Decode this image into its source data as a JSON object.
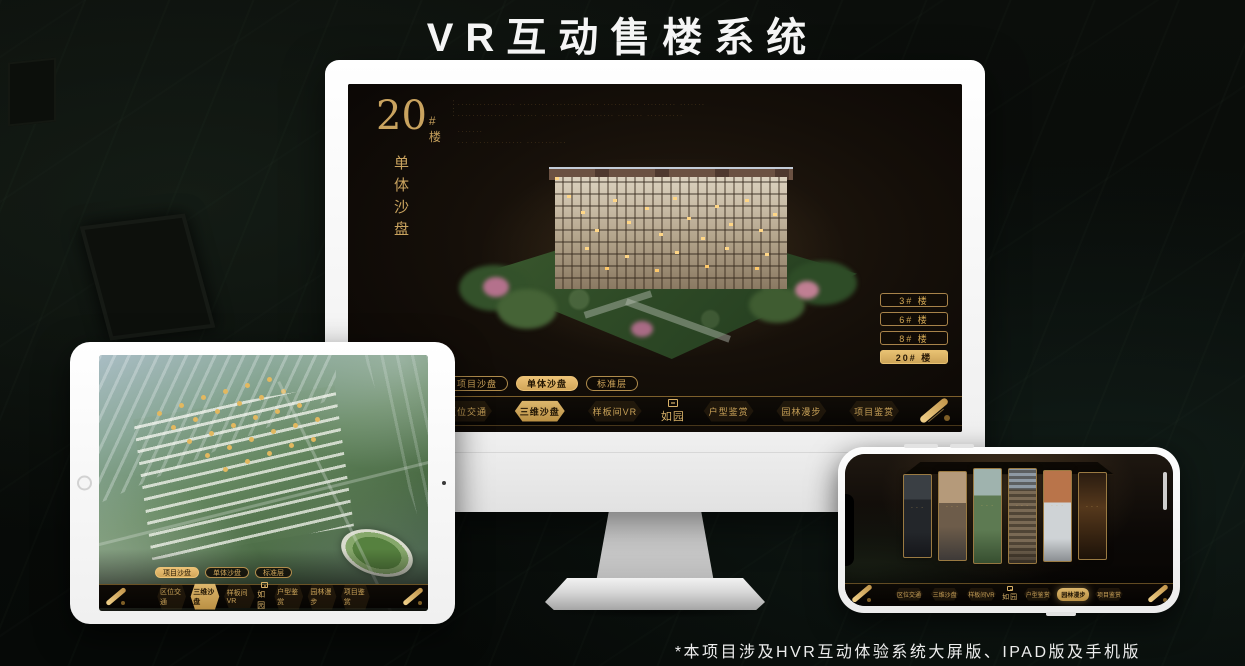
{
  "page": {
    "title": "VR互动售楼系统",
    "footnote": "*本项目涉及HVR互动体验系统大屏版、IPAD版及手机版"
  },
  "colors": {
    "gold": "#d2a85c",
    "gold_active": "#e8c172",
    "screen_background": "#120d08",
    "nav_background": "#0b0805",
    "title_white": "#f5f5f5"
  },
  "monitor": {
    "badge": {
      "number": "20",
      "suffix": "#楼",
      "title": "单体沙盘",
      "side_marks": "·····"
    },
    "description_lines": [
      "················ ········ ············· ·········· ········· ·······",
      "·············· ······· ·········· ········· ······· ··········",
      "·······",
      "··· ·············· ···········"
    ],
    "floor_buttons": [
      {
        "label": "3# 楼",
        "active": false
      },
      {
        "label": "6# 楼",
        "active": false
      },
      {
        "label": "8# 楼",
        "active": false
      },
      {
        "label": "20# 楼",
        "active": true
      }
    ],
    "sub_tabs": [
      {
        "label": "项目沙盘",
        "active": false
      },
      {
        "label": "单体沙盘",
        "active": true
      },
      {
        "label": "标准层",
        "active": false
      }
    ],
    "nav": {
      "items": [
        {
          "label": "区位交通",
          "active": false
        },
        {
          "label": "三维沙盘",
          "active": true
        },
        {
          "label": "样板间VR",
          "active": false
        },
        {
          "label": "户型鉴赏",
          "active": false
        },
        {
          "label": "园林漫步",
          "active": false
        },
        {
          "label": "项目鉴赏",
          "active": false
        }
      ],
      "logo": "如园"
    }
  },
  "ipad": {
    "sub_tabs": [
      {
        "label": "项目沙盘",
        "active": true
      },
      {
        "label": "单体沙盘",
        "active": false
      },
      {
        "label": "标准层",
        "active": false
      }
    ],
    "nav": {
      "items": [
        {
          "label": "区位交通",
          "active": false
        },
        {
          "label": "三维沙盘",
          "active": true
        },
        {
          "label": "样板间VR",
          "active": false
        },
        {
          "label": "户型鉴赏",
          "active": false
        },
        {
          "label": "园林漫步",
          "active": false
        },
        {
          "label": "项目鉴赏",
          "active": false
        }
      ],
      "logo": "如园"
    }
  },
  "phone": {
    "nav": {
      "items": [
        {
          "label": "区位交通",
          "active": false
        },
        {
          "label": "三维沙盘",
          "active": false
        },
        {
          "label": "样板间VR",
          "active": false
        },
        {
          "label": "户型鉴赏",
          "active": false
        },
        {
          "label": "园林漫步",
          "active": true
        },
        {
          "label": "项目鉴赏",
          "active": false
        }
      ],
      "logo": "如园"
    },
    "cards": [
      {
        "theme": "interior-dark"
      },
      {
        "theme": "interior-warm"
      },
      {
        "theme": "garden-path"
      },
      {
        "theme": "building-facade"
      },
      {
        "theme": "autumn-courtyard"
      },
      {
        "theme": "lounge-shelves"
      }
    ]
  }
}
